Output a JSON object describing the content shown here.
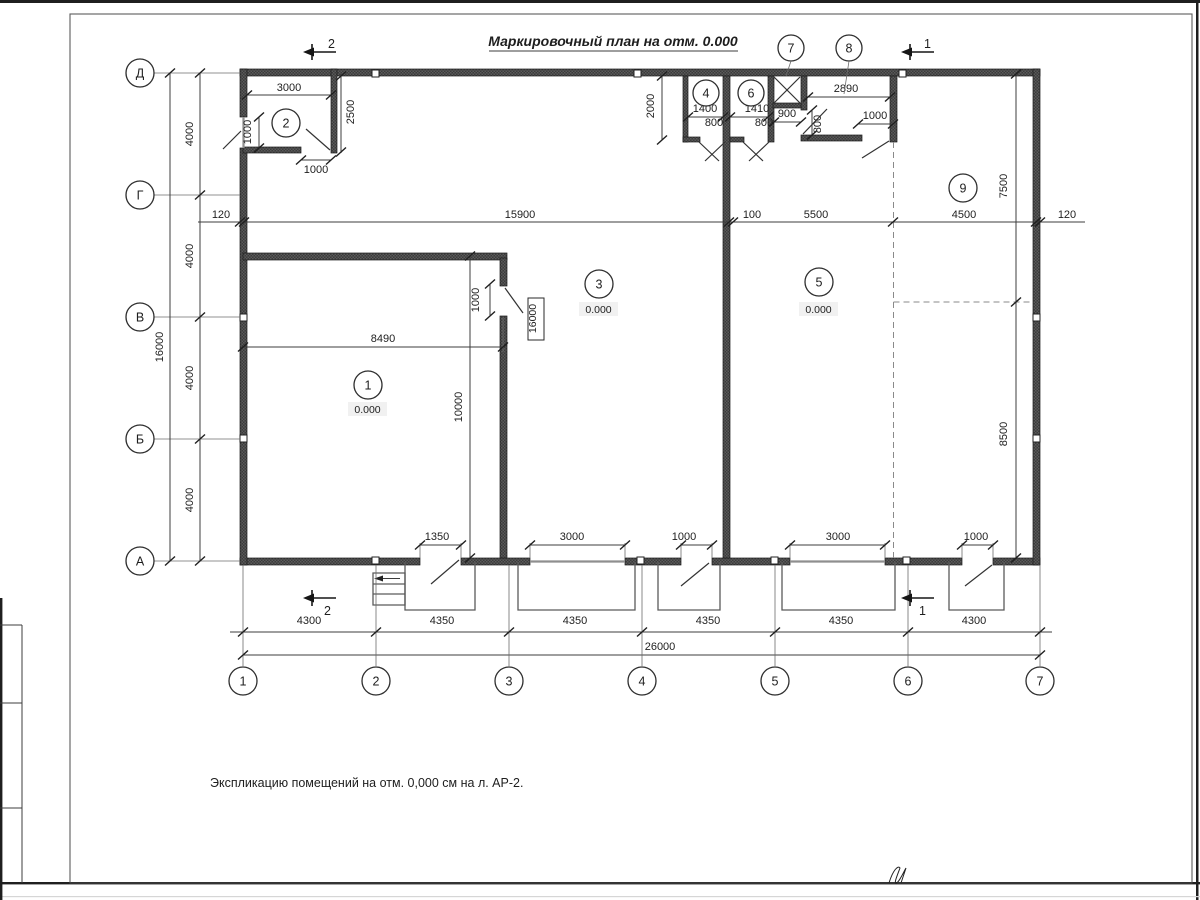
{
  "title": "Маркировочный план на отм. 0.000",
  "note": "Экспликацию помещений на отм. 0,000 см на л. АР-2.",
  "rows": [
    "Д",
    "Г",
    "В",
    "Б",
    "А"
  ],
  "cols": [
    "1",
    "2",
    "3",
    "4",
    "5",
    "6",
    "7"
  ],
  "rooms": [
    "1",
    "2",
    "3",
    "4",
    "5",
    "6",
    "7",
    "8",
    "9"
  ],
  "elev": "0.000",
  "sections": {
    "s1": "1",
    "s2": "2"
  },
  "dims": {
    "bottom": [
      "4300",
      "4350",
      "4350",
      "4350",
      "4350",
      "4300"
    ],
    "bottomTotal": "26000",
    "left": [
      "4000",
      "4000",
      "4000",
      "4000"
    ],
    "leftTotal": "16000",
    "mid": [
      "120",
      "15900",
      "100",
      "5500",
      "4500",
      "120"
    ],
    "right7500": "7500",
    "right8500": "8500",
    "w3000": "3000",
    "h2500": "2500",
    "d1000": "1000",
    "w8490": "8490",
    "h10000": "10000",
    "mark16000": "16000",
    "v2000": "2000",
    "w1400": "1400",
    "w1410": "1410",
    "w900": "900",
    "d800": "800",
    "w2890": "2890",
    "o1350": "1350"
  }
}
